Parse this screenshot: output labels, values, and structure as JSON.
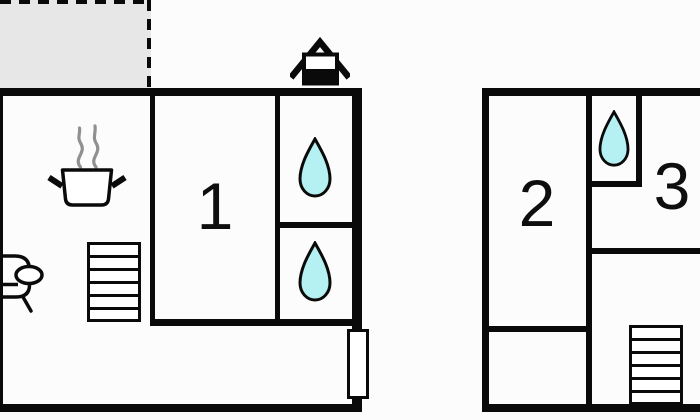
{
  "diagram": {
    "type": "floor-plan",
    "floors": [
      {
        "id": "floor-left",
        "room_labels": [
          "1"
        ],
        "features": [
          "terrace",
          "house-symbol",
          "cooking-pot",
          "sofa",
          "stairs",
          "bath-upper-drop",
          "bath-lower-drop",
          "door"
        ]
      },
      {
        "id": "floor-right",
        "room_labels": [
          "2",
          "3"
        ],
        "features": [
          "bath-drop",
          "stairs"
        ]
      }
    ]
  },
  "labels": {
    "room1": "1",
    "room2": "2",
    "room3": "3"
  },
  "icons": [
    "house-icon",
    "cooking-pot-icon",
    "steam-icon",
    "sofa-icon",
    "stairs-icon",
    "water-drop-icon",
    "door-icon"
  ],
  "colors": {
    "wall": "#0a0a0a",
    "terrace_fill": "#e7e7e7",
    "water_drop_fill": "#b5f1f2",
    "steam": "#909090",
    "background": "#fcfcfc",
    "room_fill": "#ffffff",
    "label_color": "#0e0e0e"
  }
}
